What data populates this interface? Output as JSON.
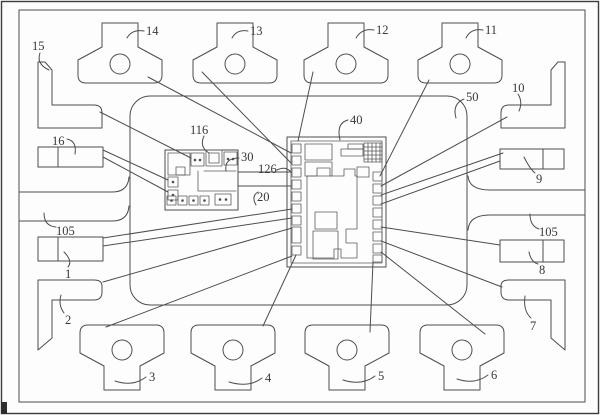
{
  "figure": {
    "type": "patent-leadframe-package-diagram",
    "colors": {
      "ink": "#4d4d4d",
      "paper": "#fdfdfd"
    },
    "labels": {
      "tab14": "14",
      "tab13": "13",
      "tab12": "12",
      "tab11": "11",
      "tab3": "3",
      "tab4": "4",
      "tab5": "5",
      "tab6": "6",
      "lead15": "15",
      "lead16": "16",
      "lead1": "1",
      "lead2": "2",
      "lead10": "10",
      "lead9": "9",
      "lead8": "8",
      "lead7": "7",
      "bar105_left": "105",
      "bar105_right": "105",
      "body50": "50",
      "chip40": "40",
      "chip30": "30",
      "comp116": "116",
      "wire126": "126",
      "wire20": "20"
    }
  }
}
